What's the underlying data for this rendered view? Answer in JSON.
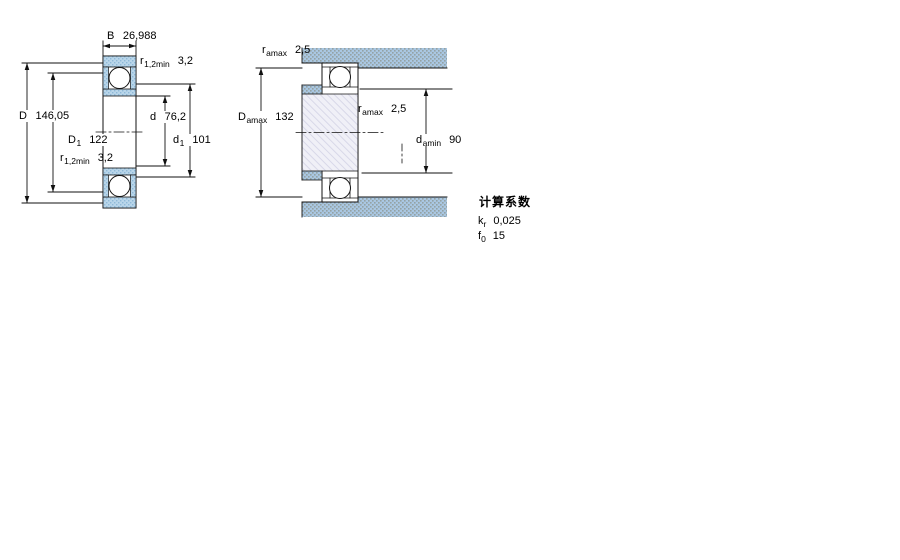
{
  "figure1": {
    "name": "bearing cross-section dimension drawing",
    "dims": {
      "B": {
        "symbol": "B",
        "value": "26,988"
      },
      "r_top": {
        "symbol": "r",
        "sub": "1,2min",
        "value": "3,2"
      },
      "D": {
        "symbol": "D",
        "value": "146,05"
      },
      "D1": {
        "symbol": "D",
        "sub": "1",
        "value": "122"
      },
      "r_bottom": {
        "symbol": "r",
        "sub": "1,2min",
        "value": "3,2"
      },
      "d": {
        "symbol": "d",
        "value": "76,2"
      },
      "d1": {
        "symbol": "d",
        "sub": "1",
        "value": "101"
      }
    }
  },
  "figure2": {
    "name": "bearing mounting abutment drawing",
    "dims": {
      "r_amax_top": {
        "symbol": "r",
        "sub": "amax",
        "value": "2,5"
      },
      "D_amax": {
        "symbol": "D",
        "sub": "amax",
        "value": "132"
      },
      "r_amax_mid": {
        "symbol": "r",
        "sub": "amax",
        "value": "2,5"
      },
      "d_amin": {
        "symbol": "d",
        "sub": "amin",
        "value": "90"
      }
    }
  },
  "calculation_factors": {
    "title": "计算系数",
    "rows": [
      {
        "symbol": "k",
        "sub": "r",
        "value": "0,025"
      },
      {
        "symbol": "f",
        "sub": "0",
        "value": "15"
      }
    ]
  },
  "colors": {
    "ring_section_blue": "#b9d6ea",
    "ring_section_dot": "#8fb9d8",
    "abutment_blue": "#a9c7e2",
    "abutment_dot": "#94a2a4",
    "shaft_hatch_bg": "#f0f0f7",
    "shaft_hatch_line": "#d8d8e8",
    "line_color": "#111111"
  }
}
